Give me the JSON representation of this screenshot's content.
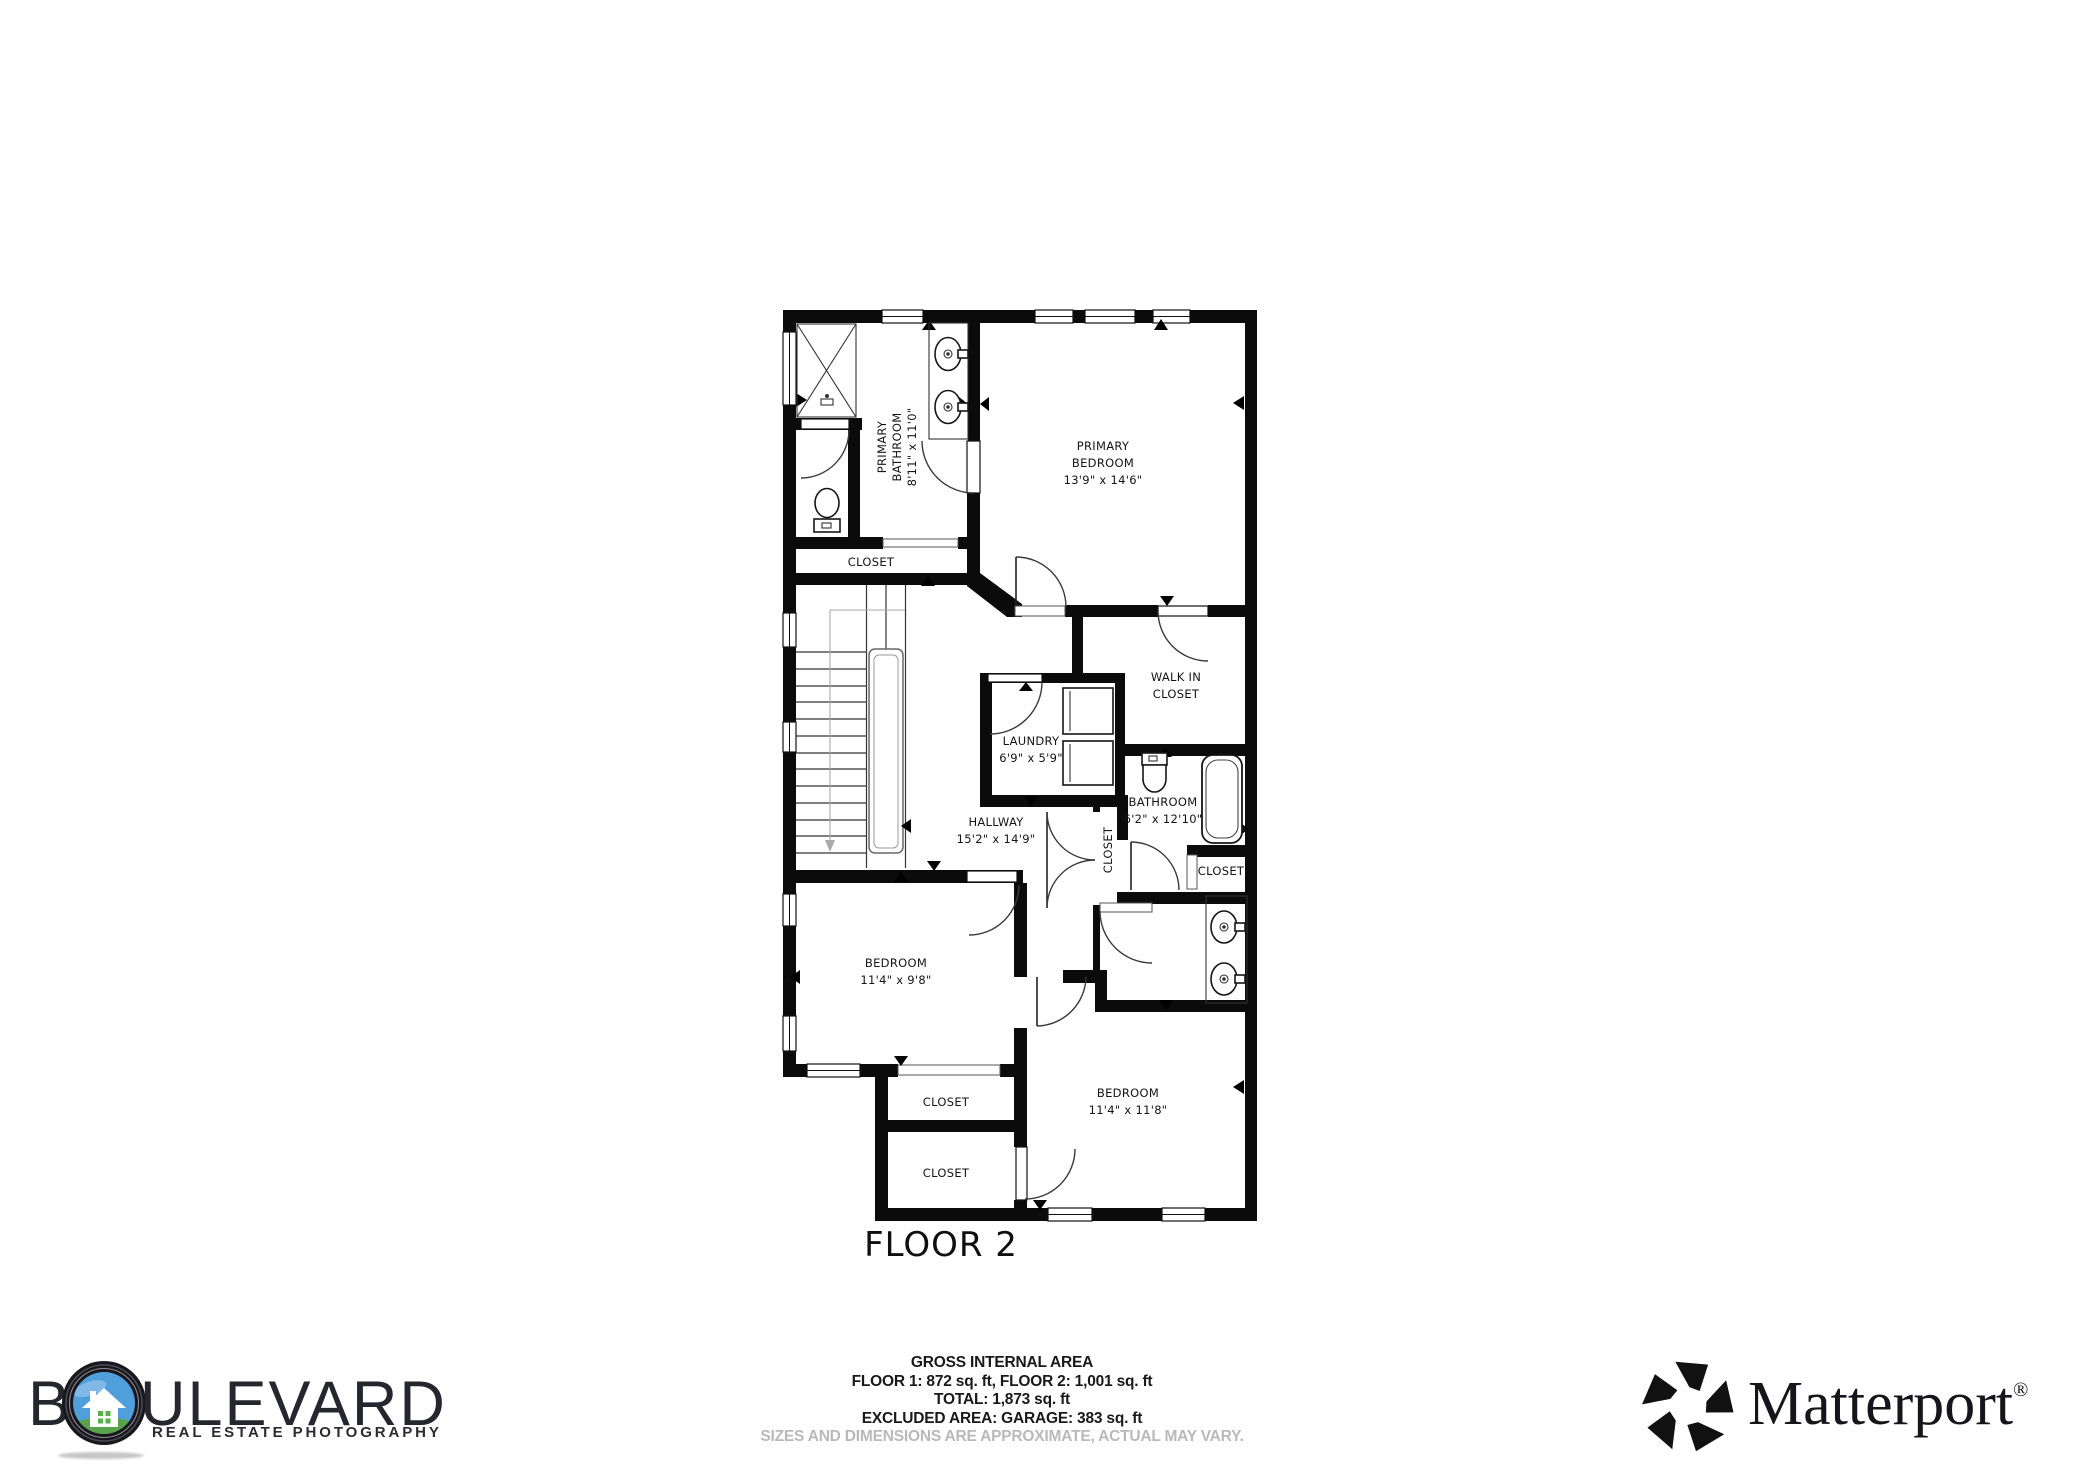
{
  "plan": {
    "floor_label": "FLOOR 2",
    "rooms": {
      "primary_bathroom": {
        "line1": "PRIMARY",
        "line2": "BATHROOM",
        "dims": "8'11\" x 11'0\""
      },
      "primary_bedroom": {
        "line1": "PRIMARY",
        "line2": "BEDROOM",
        "dims": "13'9\" x 14'6\""
      },
      "closet_primary": {
        "label": "CLOSET"
      },
      "walk_in_closet": {
        "line1": "WALK IN",
        "line2": "CLOSET"
      },
      "laundry": {
        "line1": "LAUNDRY",
        "dims": "6'9\" x 5'9\""
      },
      "hallway": {
        "line1": "HALLWAY",
        "dims": "15'2\" x 14'9\""
      },
      "closet_hallway": {
        "label": "CLOSET"
      },
      "bathroom": {
        "line1": "BATHROOM",
        "dims": "6'2\" x 12'10\""
      },
      "closet_bathroom": {
        "label": "CLOSET"
      },
      "bedroom_left": {
        "line1": "BEDROOM",
        "dims": "11'4\" x 9'8\""
      },
      "closet_one": {
        "label": "CLOSET"
      },
      "closet_two": {
        "label": "CLOSET"
      },
      "bedroom_right": {
        "line1": "BEDROOM",
        "dims": "11'4\" x 11'8\""
      }
    }
  },
  "footer": {
    "area_title": "GROSS INTERNAL AREA",
    "area_floors": "FLOOR 1: 872 sq. ft, FLOOR 2: 1,001 sq. ft",
    "area_total": "TOTAL: 1,873 sq. ft",
    "area_excluded": "EXCLUDED AREA: GARAGE: 383 sq. ft",
    "disclaimer": "SIZES AND DIMENSIONS ARE APPROXIMATE, ACTUAL MAY VARY."
  },
  "logos": {
    "boulevard": {
      "prefix": "B",
      "suffix": "ULEVARD",
      "tagline": "REAL ESTATE PHOTOGRAPHY"
    },
    "matterport": {
      "name": "Matterport",
      "registered": "®"
    }
  },
  "colors": {
    "wall": "#0b0b0b",
    "label_text": "#141414",
    "disclaimer_gray": "#b9b9b9",
    "logo_blue": "#4f9fdb",
    "logo_green": "#5aa24b",
    "logo_window_green": "#57b04a",
    "logo_text_dark": "#26262e"
  }
}
